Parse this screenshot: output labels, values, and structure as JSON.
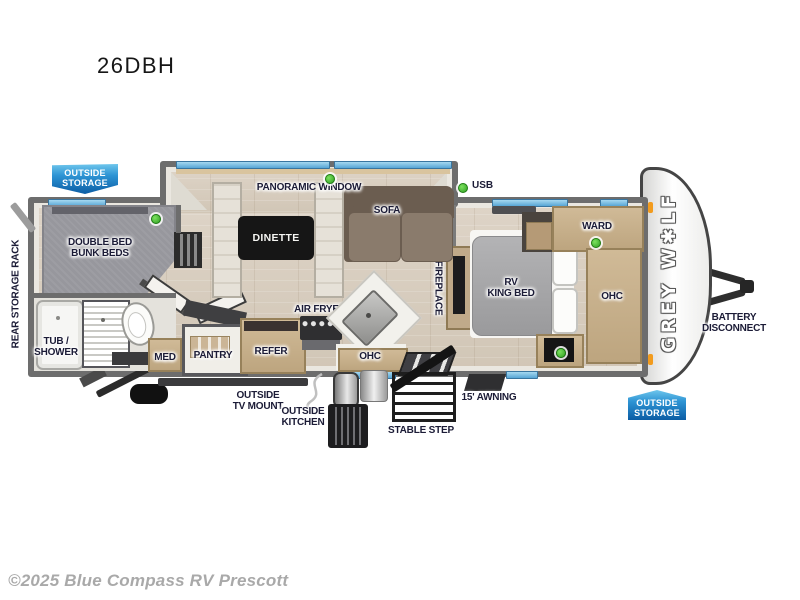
{
  "page": {
    "title": "26DBH",
    "copyright": "©2025 Blue Compass RV Prescott"
  },
  "floorplan": {
    "brand_logo": "GREY W✱LF",
    "badges": {
      "outside_storage": [
        "OUTSIDE",
        "STORAGE"
      ]
    },
    "labels": {
      "rear_storage_rack": "REAR STORAGE RACK",
      "double_bed_bunk_beds": [
        "DOUBLE BED",
        "BUNK BEDS"
      ],
      "panoramic_window": "PANORAMIC WINDOW",
      "dinette": "DINETTE",
      "sofa": "SOFA",
      "usb": "USB",
      "tub_shower": [
        "TUB /",
        "SHOWER"
      ],
      "med": "MED",
      "pantry": "PANTRY",
      "refer": "REFER",
      "air_fryer": "AIR FRYER",
      "ohc_kitchen": "OHC",
      "fireplace": "FIREPLACE",
      "rv_king_bed": [
        "RV",
        "KING BED"
      ],
      "ward": "WARD",
      "ohc_bedroom": "OHC",
      "battery_disconnect": [
        "BATTERY",
        "DISCONNECT"
      ],
      "outside_tv_mount": [
        "OUTSIDE",
        "TV MOUNT"
      ],
      "outside_kitchen": [
        "OUTSIDE",
        "KITCHEN"
      ],
      "stable_step": "STABLE STEP",
      "awning": "15' AWNING"
    },
    "colors": {
      "badge_blue_top": "#6ec6ec",
      "badge_blue_bottom": "#0b5ca4",
      "wall_gray": "#6d6d6d",
      "floor_wood": "#d8cec0",
      "bunk_carpet": "#97979d",
      "cabinet_tan": "#c7b193",
      "sofa_brown": "#75675a",
      "led_green": "#3fbf2f",
      "window_blue": "#7cc3e8",
      "marker_orange": "#f29b1d"
    }
  }
}
